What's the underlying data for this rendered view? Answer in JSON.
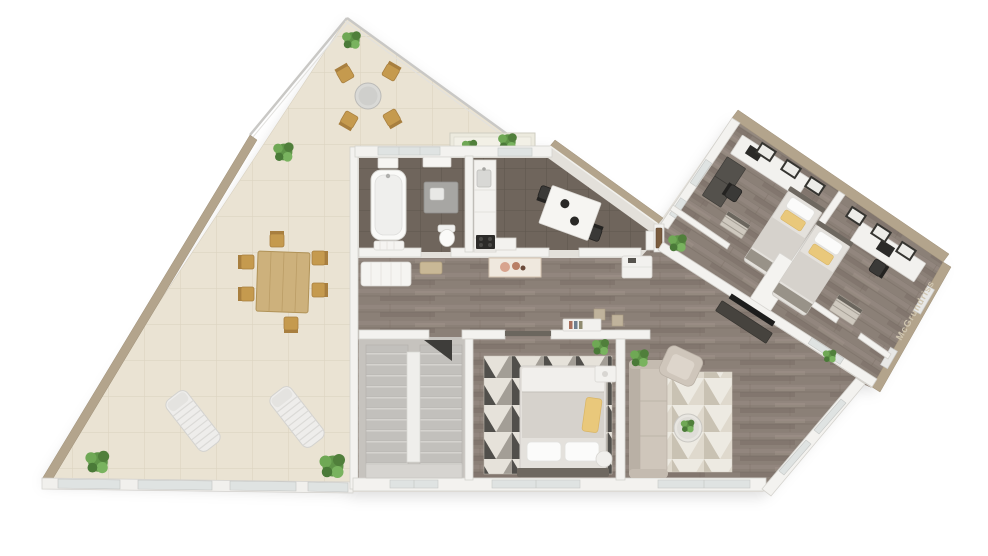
{
  "scene": {
    "description": "3D rendered top-down floor plan of an apartment with a large triangular wrap-around terrace, bathroom, kitchen-dining room, hallway, staircase room, master bedroom, living room and a rotated wing with two kids bedrooms",
    "render_style": "photorealistic 3D floor plan on white background"
  },
  "watermark": {
    "text": "McGrundriss"
  },
  "palette": {
    "background": "#ffffff",
    "outer_wall": "#b3a48c",
    "outer_wall_dark": "#9e8f77",
    "inner_wall": "#f3f2ef",
    "inner_wall_edge": "#d4d2cd",
    "terrace_tile": "#eae3d3",
    "terrace_grout": "#dcd4c2",
    "wood_floor": "#8b8077",
    "dark_tile": "#6f655c",
    "dark_tile_grout": "#5f564e",
    "stair_gray": "#c6c3be",
    "furniture_white": "#f2f1ee",
    "sofa_beige": "#cfc6bb",
    "wood_furniture": "#c59a4e",
    "accent_yellow": "#e9c87b",
    "plant_green": "#5f9448",
    "rug_dark": "#514f4b",
    "rug_light": "#e6e2da",
    "rug_mid": "#a39e96",
    "glass": "#dfe3e2",
    "door_wood": "#7a5c3e",
    "watermark_color": "#cfc5b0"
  },
  "rooms": [
    {
      "name": "terrace",
      "floor": "light beige tile"
    },
    {
      "name": "kitchen-balcony",
      "floor": "tile"
    },
    {
      "name": "bathroom",
      "floor": "dark tile"
    },
    {
      "name": "kitchen-dining",
      "floor": "dark tile"
    },
    {
      "name": "hallway",
      "floor": "wood"
    },
    {
      "name": "staircase-room",
      "floor": "gray screed"
    },
    {
      "name": "master-bedroom",
      "floor": "wood"
    },
    {
      "name": "living-room",
      "floor": "wood"
    },
    {
      "name": "wing-hallway",
      "floor": "wood"
    },
    {
      "name": "kids-bedroom-1",
      "floor": "wood"
    },
    {
      "name": "kids-bedroom-2",
      "floor": "wood"
    }
  ],
  "furniture_inventory": {
    "beds": 3,
    "sofa": 1,
    "armchair": 1,
    "coffee_table": 1,
    "tv": 1,
    "dining_table_indoor": 1,
    "dining_chairs_indoor": 2,
    "desks": 2,
    "desk_chairs": 2,
    "wardrobes_dressers": 3,
    "bathtub": 1,
    "vanity": 1,
    "toilet": 1,
    "staircase": 1,
    "area_rugs": 2,
    "sun_loungers": 2,
    "outdoor_dining_chairs": 6,
    "bistro_chairs": 4,
    "plants": 11
  }
}
